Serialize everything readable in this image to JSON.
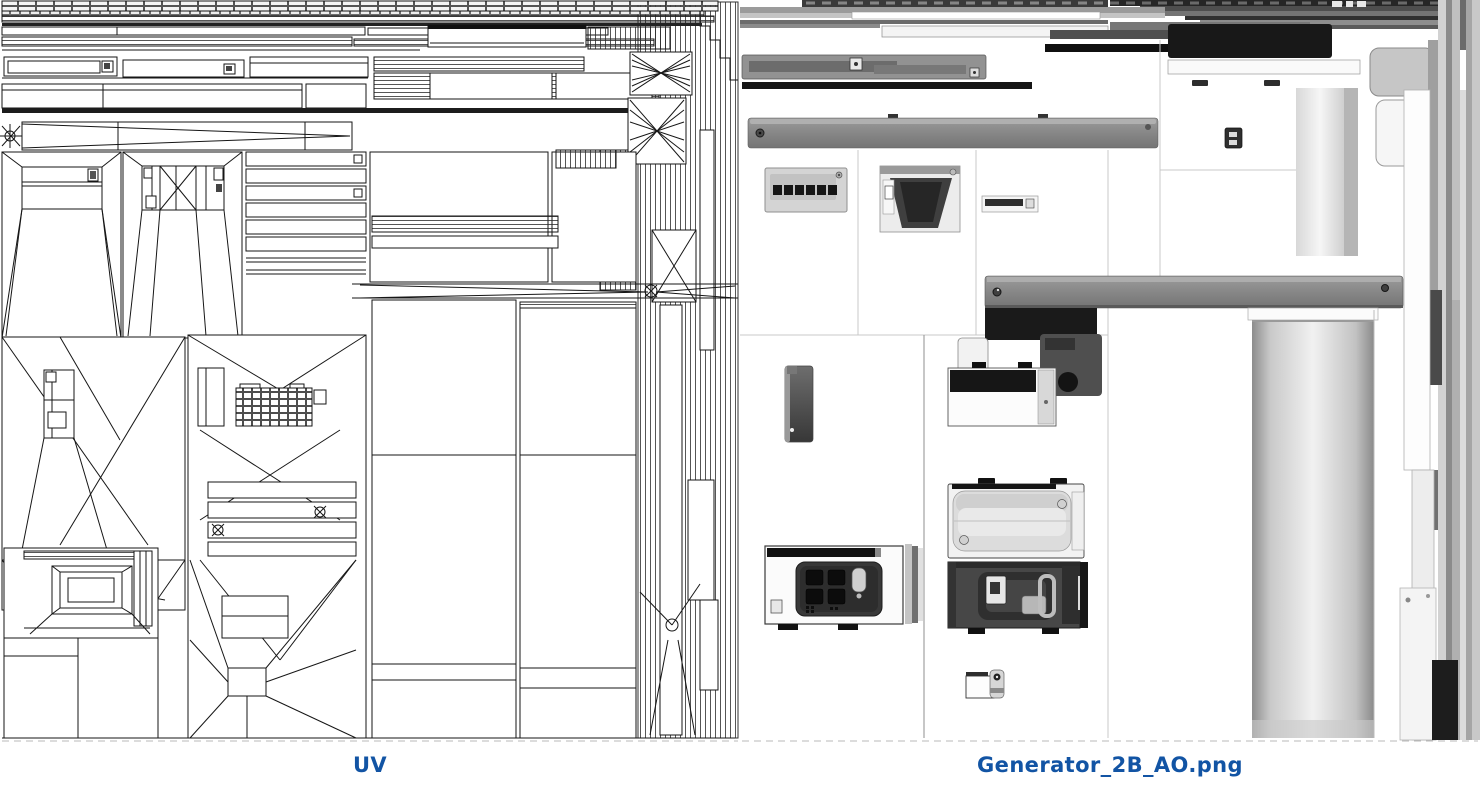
{
  "page": {
    "background": "#ffffff"
  },
  "colors": {
    "caption_blue": "#1254a4",
    "wireframe_ink": "#161616",
    "ao_beam_gray": "#8a8a8a",
    "ao_black": "#151515"
  },
  "figures": {
    "uv": {
      "caption": "UV"
    },
    "ao": {
      "caption": "Generator_2B_AO.png"
    }
  }
}
